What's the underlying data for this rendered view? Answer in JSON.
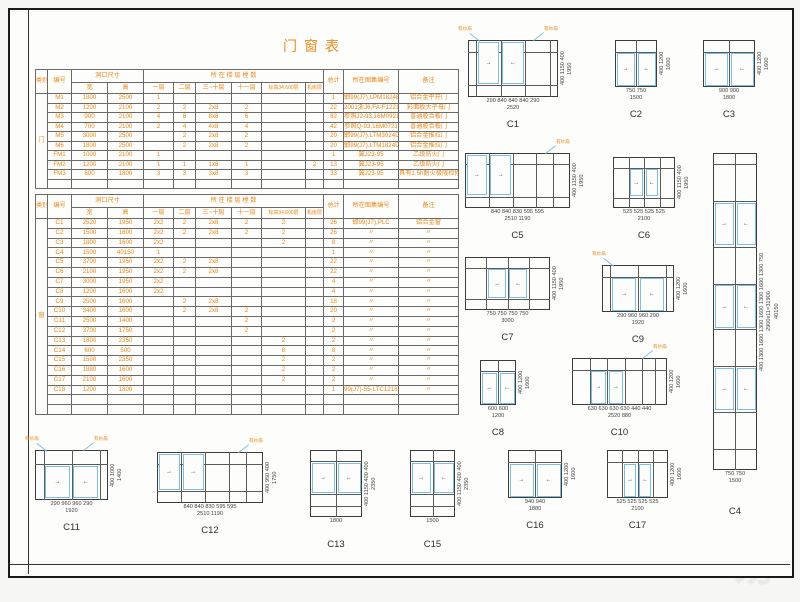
{
  "sheet_title": "门窗表",
  "leader_label": "有纱扇",
  "watermark_glyph": "易",
  "colors": {
    "accent_orange": "#e8891c",
    "sash_blue": "#7cc0dd",
    "line_dark": "#3c3c3c",
    "watermark_gray": "#e9e9e6"
  },
  "schedule_headers": {
    "category": "类别",
    "number": "编号",
    "opening_size": "洞口尺寸",
    "width": "宽",
    "height": "高",
    "floors_group": "所 在 楼 层 樘 数",
    "floor1": "一层",
    "floor2": "二层",
    "floor3_10": "三~十层",
    "floor11": "十一层",
    "elev34600": "标高34.600层",
    "machine_room": "机房层",
    "total": "总计",
    "atlas_no": "所在图集编号",
    "remark": "备注"
  },
  "door_table": {
    "category": "门",
    "rows": [
      [
        "M1",
        "1800",
        "2500",
        "1",
        "",
        "",
        "",
        "",
        "",
        "1",
        "邯99(J7),LPM1824B",
        "铝合金平开门"
      ],
      [
        "M2",
        "1200",
        "2100",
        "2",
        "2",
        "2x8",
        "2",
        "",
        "",
        "22",
        "2001浙J6,FA-F1221",
        "彩面板大子母门"
      ],
      [
        "M3",
        "900",
        "2100",
        "4",
        "8",
        "8x8",
        "6",
        "",
        "",
        "82",
        "参照J2-93,16M0921",
        "普通胶合板门"
      ],
      [
        "M4",
        "700",
        "2100",
        "2",
        "4",
        "4x8",
        "4",
        "",
        "",
        "42",
        "参照Q-93,16M0721",
        "普通胶合板门"
      ],
      [
        "M5",
        "3000",
        "2500",
        "",
        "2",
        "2x8",
        "2",
        "",
        "",
        "20",
        "邯99(J7),LTM3024D",
        "铝合金推拉门"
      ],
      [
        "M6",
        "1800",
        "2500",
        "",
        "2",
        "2x8",
        "2",
        "",
        "",
        "20",
        "邯99(J7),LTM1824D",
        "铝合金推拉门"
      ],
      [
        "FM1",
        "1000",
        "2100",
        "1",
        "",
        "",
        "",
        "",
        "",
        "1",
        "冀J23-95",
        "乙级防火门"
      ],
      [
        "FM2",
        "1200",
        "2100",
        "1",
        "1",
        "1x8",
        "1",
        "",
        "2",
        "13",
        "冀J23-95",
        "乙级防火门"
      ],
      [
        "FM3",
        "600",
        "1800",
        "3",
        "3",
        "3x8",
        "3",
        "",
        "",
        "33",
        "冀J23-95",
        "具有1.5h耐火极限检修门"
      ]
    ],
    "empty_rows": 1
  },
  "window_table": {
    "category": "窗",
    "rows": [
      [
        "C1",
        "2520",
        "1950",
        "2x2",
        "2",
        "2x8",
        "2",
        "2",
        "",
        "26",
        "邯99(J7),PLC",
        "铝合金窗"
      ],
      [
        "C2",
        "1500",
        "1600",
        "2x2",
        "2",
        "2x8",
        "2",
        "2",
        "",
        "26",
        "〃",
        "〃"
      ],
      [
        "C3",
        "1800",
        "1600",
        "2x2",
        "",
        "",
        "",
        "2",
        "",
        "8",
        "〃",
        "〃"
      ],
      [
        "C4",
        "1500",
        "40150",
        "1",
        "",
        "",
        "",
        "",
        "",
        "1",
        "〃",
        "〃"
      ],
      [
        "C5",
        "3700",
        "1950",
        "2x2",
        "2",
        "2x8",
        "",
        "",
        "",
        "22",
        "〃",
        "〃"
      ],
      [
        "C6",
        "2100",
        "1950",
        "2x2",
        "2",
        "2x8",
        "",
        "",
        "",
        "22",
        "〃",
        "〃"
      ],
      [
        "C7",
        "3000",
        "1950",
        "2x2",
        "",
        "",
        "",
        "",
        "",
        "4",
        "〃",
        "〃"
      ],
      [
        "C8",
        "1200",
        "1600",
        "2x2",
        "",
        "",
        "",
        "",
        "",
        "4",
        "〃",
        "〃"
      ],
      [
        "C9",
        "2500",
        "1600",
        "",
        "2",
        "2x8",
        "",
        "",
        "",
        "18",
        "〃",
        "〃"
      ],
      [
        "C10",
        "3400",
        "1600",
        "",
        "2",
        "2x8",
        "2",
        "",
        "",
        "20",
        "〃",
        "〃"
      ],
      [
        "C11",
        "2500",
        "1400",
        "",
        "",
        "",
        "2",
        "",
        "",
        "2",
        "〃",
        "〃"
      ],
      [
        "C12",
        "3700",
        "1750",
        "",
        "",
        "",
        "2",
        "",
        "",
        "2",
        "〃",
        "〃"
      ],
      [
        "C13",
        "1800",
        "2350",
        "",
        "",
        "",
        "",
        "2",
        "",
        "2",
        "〃",
        "〃"
      ],
      [
        "C14",
        "600",
        "500",
        "",
        "",
        "",
        "",
        "8",
        "",
        "8",
        "〃",
        "〃"
      ],
      [
        "C15",
        "1500",
        "2350",
        "",
        "",
        "",
        "",
        "2",
        "",
        "2",
        "〃",
        "〃"
      ],
      [
        "C16",
        "1880",
        "1600",
        "",
        "",
        "",
        "",
        "2",
        "",
        "2",
        "〃",
        "〃"
      ],
      [
        "C17",
        "2100",
        "1600",
        "",
        "",
        "",
        "",
        "2",
        "",
        "2",
        "〃",
        "〃"
      ],
      [
        "C18",
        "1200",
        "1800",
        "",
        "",
        "",
        "",
        "",
        "",
        "1",
        "99(J7)-55-LTC1218B",
        "〃"
      ]
    ],
    "empty_rows": 2
  },
  "diagrams": [
    {
      "id": "C1",
      "cols": [
        290,
        840,
        840,
        840,
        290
      ],
      "rows": [
        400,
        1150,
        400
      ],
      "sashes": [
        {
          "c": 1,
          "r": 0,
          "rs": 2
        },
        {
          "c": 2,
          "r": 0,
          "rs": 2
        }
      ],
      "dimA": [
        "290",
        "840",
        "840",
        "840",
        "290"
      ],
      "dimB": [
        "2520"
      ],
      "dimR": [
        "400",
        "1150",
        "400"
      ],
      "dimRT": [
        "1950"
      ],
      "leaders": [
        "l",
        "r"
      ]
    },
    {
      "id": "C2",
      "cols": [
        750,
        750
      ],
      "rows": [
        400,
        1200
      ],
      "sashes": [
        {
          "c": 0,
          "r": 1
        },
        {
          "c": 1,
          "r": 1
        }
      ],
      "dimA": [
        "750",
        "750"
      ],
      "dimB": [
        "1500"
      ],
      "dimR": [
        "400",
        "1200"
      ],
      "dimRT": [
        "1600"
      ],
      "leaders": []
    },
    {
      "id": "C3",
      "cols": [
        900,
        900
      ],
      "rows": [
        400,
        1200
      ],
      "sashes": [
        {
          "c": 0,
          "r": 1
        },
        {
          "c": 1,
          "r": 1
        }
      ],
      "dimA": [
        "900",
        "900"
      ],
      "dimB": [
        "1800"
      ],
      "dimR": [
        "400",
        "1200"
      ],
      "dimRT": [
        "1600"
      ],
      "leaders": []
    },
    {
      "id": "C5",
      "cols": [
        840,
        840,
        830,
        595,
        595
      ],
      "rows": [
        400,
        1150,
        400
      ],
      "sashes": [
        {
          "c": 0,
          "r": 0,
          "rs": 2
        },
        {
          "c": 1,
          "r": 0,
          "rs": 2
        }
      ],
      "dimA": [
        "840",
        "840",
        "830",
        "595",
        "595"
      ],
      "dimB": [
        "2510",
        "1190"
      ],
      "dimR": [
        "400",
        "1150",
        "400"
      ],
      "dimRT": [
        "1950"
      ],
      "leaders": [
        "r"
      ]
    },
    {
      "id": "C6",
      "cols": [
        525,
        525,
        525,
        525
      ],
      "rows": [
        400,
        1150,
        400
      ],
      "sashes": [
        {
          "c": 1,
          "r": 1
        },
        {
          "c": 2,
          "r": 1
        }
      ],
      "dimA": [
        "525",
        "525",
        "525",
        "525"
      ],
      "dimB": [
        "2100"
      ],
      "dimR": [
        "400",
        "1150",
        "400"
      ],
      "dimRT": [
        "1950"
      ],
      "leaders": []
    },
    {
      "id": "C4",
      "cols": [
        750,
        750
      ],
      "rows": [
        400,
        1300,
        1600,
        1300,
        1600,
        1300,
        1600,
        1300,
        750
      ],
      "sashes": [
        {
          "c": 0,
          "r": 2
        },
        {
          "c": 1,
          "r": 2
        },
        {
          "c": 0,
          "r": 4
        },
        {
          "c": 1,
          "r": 4
        },
        {
          "c": 0,
          "r": 6
        },
        {
          "c": 1,
          "r": 6
        }
      ],
      "dimA": [
        "750",
        "750"
      ],
      "dimB": [
        "1500"
      ],
      "dimR": [
        "400",
        "1300",
        "1600",
        "1300",
        "1600",
        "1300",
        "1600",
        "1300",
        "750"
      ],
      "dimRT": [
        "2900x11=31900",
        "40150"
      ],
      "leaders": []
    },
    {
      "id": "C7",
      "cols": [
        750,
        750,
        750,
        750
      ],
      "rows": [
        400,
        1150,
        400
      ],
      "sashes": [
        {
          "c": 1,
          "r": 1
        },
        {
          "c": 2,
          "r": 1
        }
      ],
      "dimA": [
        "750",
        "750",
        "750",
        "750"
      ],
      "dimB": [
        "3000"
      ],
      "dimR": [
        "400",
        "1150",
        "400"
      ],
      "dimRT": [
        "1950"
      ],
      "leaders": []
    },
    {
      "id": "C9",
      "cols": [
        290,
        960,
        960,
        290
      ],
      "rows": [
        400,
        1200
      ],
      "sashes": [
        {
          "c": 1,
          "r": 1
        },
        {
          "c": 2,
          "r": 1
        }
      ],
      "dimA": [
        "290",
        "960",
        "960",
        "290"
      ],
      "dimB": [
        "1920"
      ],
      "dimR": [
        "400",
        "1200"
      ],
      "dimRT": [
        "1600"
      ],
      "leaders": [
        "l"
      ]
    },
    {
      "id": "C8",
      "cols": [
        600,
        600
      ],
      "rows": [
        400,
        1200
      ],
      "sashes": [
        {
          "c": 0,
          "r": 1
        },
        {
          "c": 1,
          "r": 1
        }
      ],
      "dimA": [
        "600",
        "600"
      ],
      "dimB": [
        "1200"
      ],
      "dimR": [
        "400",
        "1200"
      ],
      "dimRT": [
        "1600"
      ],
      "leaders": []
    },
    {
      "id": "C10",
      "cols": [
        630,
        630,
        630,
        630,
        440,
        440
      ],
      "rows": [
        400,
        1200
      ],
      "sashes": [
        {
          "c": 1,
          "r": 1
        },
        {
          "c": 2,
          "r": 1
        }
      ],
      "dimA": [
        "630",
        "630",
        "630",
        "630",
        "440",
        "440"
      ],
      "dimB": [
        "2520",
        "880"
      ],
      "dimR": [
        "400",
        "1200"
      ],
      "dimRT": [
        "1600"
      ],
      "leaders": [
        "r"
      ]
    },
    {
      "id": "C11",
      "cols": [
        290,
        960,
        960,
        290
      ],
      "rows": [
        400,
        1000
      ],
      "sashes": [
        {
          "c": 1,
          "r": 1
        },
        {
          "c": 2,
          "r": 1
        }
      ],
      "dimA": [
        "290",
        "960",
        "960",
        "290"
      ],
      "dimB": [
        "1920"
      ],
      "dimR": [
        "400",
        "1000"
      ],
      "dimRT": [
        "1400"
      ],
      "leaders": [
        "l",
        "r"
      ]
    },
    {
      "id": "C12",
      "cols": [
        840,
        840,
        830,
        595,
        595
      ],
      "rows": [
        400,
        950,
        400
      ],
      "sashes": [
        {
          "c": 0,
          "r": 0,
          "rs": 2
        },
        {
          "c": 1,
          "r": 0,
          "rs": 2
        }
      ],
      "dimA": [
        "840",
        "840",
        "830",
        "595",
        "595"
      ],
      "dimB": [
        "2510",
        "1190"
      ],
      "dimR": [
        "400",
        "950",
        "400"
      ],
      "dimRT": [
        "1750"
      ],
      "leaders": [
        "r"
      ]
    },
    {
      "id": "C13",
      "cols": [
        900,
        900
      ],
      "rows": [
        400,
        1150,
        400,
        400
      ],
      "sashes": [
        {
          "c": 0,
          "r": 1
        },
        {
          "c": 1,
          "r": 1
        }
      ],
      "dimA": [
        "1800"
      ],
      "dimB": [],
      "dimR": [
        "400",
        "1150",
        "400",
        "400"
      ],
      "dimRT": [
        "2350"
      ],
      "leaders": []
    },
    {
      "id": "C15",
      "cols": [
        750,
        750
      ],
      "rows": [
        400,
        1150,
        400,
        400
      ],
      "sashes": [
        {
          "c": 0,
          "r": 1
        },
        {
          "c": 1,
          "r": 1
        }
      ],
      "dimA": [
        "1500"
      ],
      "dimB": [],
      "dimR": [
        "400",
        "1150",
        "400",
        "400"
      ],
      "dimRT": [
        "2350"
      ],
      "leaders": []
    },
    {
      "id": "C16",
      "cols": [
        940,
        940
      ],
      "rows": [
        400,
        1200
      ],
      "sashes": [
        {
          "c": 0,
          "r": 1
        },
        {
          "c": 1,
          "r": 1
        }
      ],
      "dimA": [
        "940",
        "940"
      ],
      "dimB": [
        "1880"
      ],
      "dimR": [
        "400",
        "1200"
      ],
      "dimRT": [
        "1600"
      ],
      "leaders": []
    },
    {
      "id": "C17",
      "cols": [
        525,
        525,
        525,
        525
      ],
      "rows": [
        400,
        1200
      ],
      "sashes": [
        {
          "c": 1,
          "r": 1
        },
        {
          "c": 2,
          "r": 1
        }
      ],
      "dimA": [
        "525",
        "525",
        "525",
        "525"
      ],
      "dimB": [
        "2100"
      ],
      "dimR": [
        "400",
        "1200"
      ],
      "dimRT": [
        "1600"
      ],
      "leaders": []
    }
  ]
}
